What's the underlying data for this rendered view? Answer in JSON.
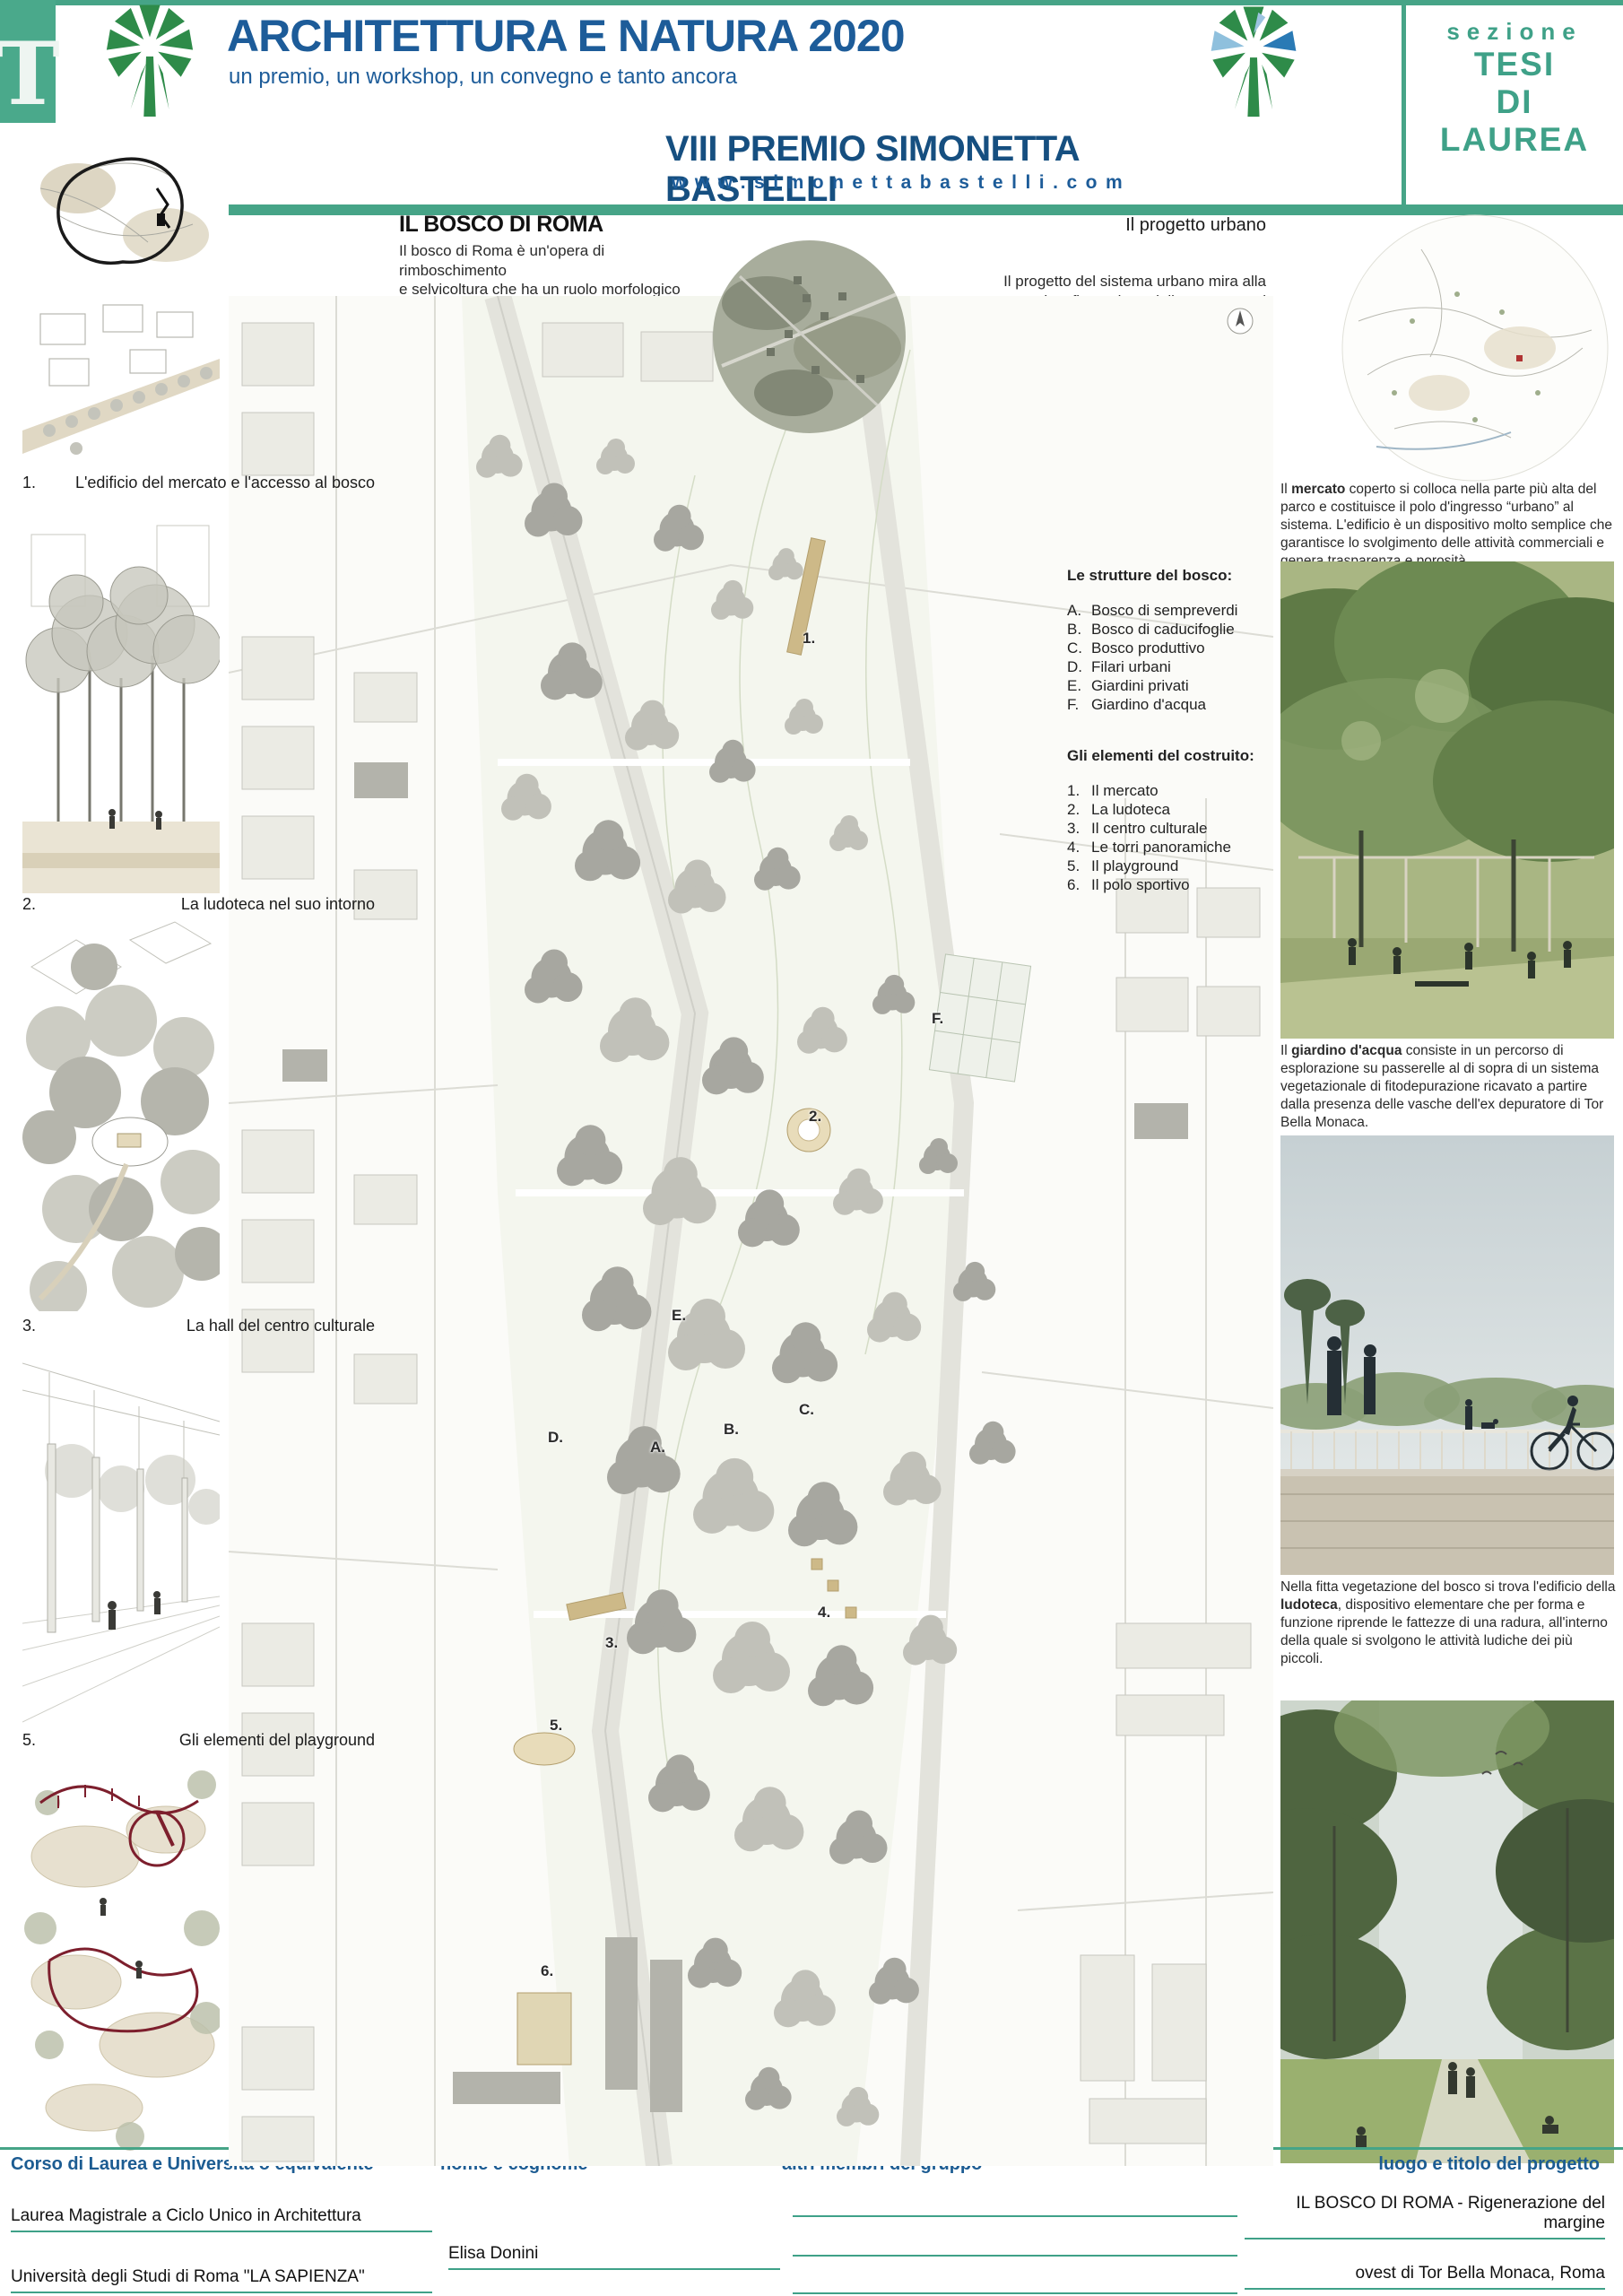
{
  "colors": {
    "accent_green": "#46a487",
    "title_blue": "#1d5c99",
    "logo_green": "#2e8b49",
    "footer_blue": "#1c5c92",
    "playground_red": "#7d1f2d"
  },
  "header": {
    "tab_letter": "T",
    "title": "ARCHITETTURA E NATURA 2020",
    "subtitle": "un premio, un workshop, un convegno e tanto ancora",
    "prize": "VIII PREMIO SIMONETTA BASTELLI",
    "website": "www.simonettabastelli.com",
    "section_label": "sezione",
    "section_lines": [
      "TESI",
      "DI",
      "LAUREA"
    ]
  },
  "intro": {
    "title": "IL BOSCO DI ROMA",
    "body": "Il bosco di Roma è un'opera di rimboschimento\ne selvicoltura che ha un ruolo morfologico\ndi contenimento dello sprawl, definendone\nun margine fisico, e un ruolo ambientale\ndi opposizione all'isolamento di alcuni fragili\nhabitat.\nIl settore di progetto è una fascia di 25 ettari, al\nmargine fra i quartieri di Tor Bella Monaca a est e\nTorre Angela a ovest, nell'ambito della centralità\nlocale n° 3 dell'ex VIII Municipio, oggi VI, di Roma.\nLa centralità ricomprende alcune aree adibite a\nservizi già esistenti (scuole, chiesa, attrezzature\nsportive e ricreative e aree a verde)."
  },
  "urban": {
    "title": "Il progetto urbano",
    "body": "Il progetto del sistema urbano mira alla\nriconfigurazione delle componenti\ninfrastrutturali e storico-ambientali esistenti\nattraverso un ridisegno paesaggistico esteso\nalla scala territoriale.\nLe masse boschive costituiscono la figura\nprincipale del nuovo assetto e vanno a integrarsi\nalla definizione di percorsi pedonali di\ncollegamento fra Tor Bella Monaca\ne Torre Angela e a una pista\nciclabile che prosegue anche verso est."
  },
  "left_panels": [
    {
      "num": "1.",
      "label": "L'edificio del mercato e l'accesso al bosco"
    },
    {
      "num": "2.",
      "label": "La ludoteca nel suo intorno"
    },
    {
      "num": "3.",
      "label": "La hall del centro culturale"
    },
    {
      "num": "5.",
      "label": "Gli elementi del playground"
    }
  ],
  "legend": {
    "bosco_title": "Le strutture del bosco:",
    "bosco": [
      {
        "key": "A.",
        "label": "Bosco di sempreverdi"
      },
      {
        "key": "B.",
        "label": "Bosco di caducifoglie"
      },
      {
        "key": "C.",
        "label": "Bosco produttivo"
      },
      {
        "key": "D.",
        "label": "Filari urbani"
      },
      {
        "key": "E.",
        "label": "Giardini privati"
      },
      {
        "key": "F.",
        "label": "Giardino d'acqua"
      }
    ],
    "costruito_title": "Gli elementi del costruito:",
    "costruito": [
      {
        "key": "1.",
        "label": "Il mercato"
      },
      {
        "key": "2.",
        "label": "La ludoteca"
      },
      {
        "key": "3.",
        "label": "Il centro culturale"
      },
      {
        "key": "4.",
        "label": "Le torri panoramiche"
      },
      {
        "key": "5.",
        "label": "Il playground"
      },
      {
        "key": "6.",
        "label": "Il polo sportivo"
      }
    ]
  },
  "plan": {
    "markers": [
      "1.",
      "2.",
      "3.",
      "4.",
      "5.",
      "6.",
      "A.",
      "B.",
      "C.",
      "D.",
      "E.",
      "F."
    ]
  },
  "captions": [
    {
      "pre": "Il ",
      "bold": "mercato",
      "post": " coperto si colloca nella parte più alta del parco e costituisce il polo d'ingresso “urbano” al sistema. L'edificio è un dispositivo molto semplice che garantisce lo svolgimento delle attività commerciali e genera trasparenza e porosità."
    },
    {
      "pre": "Il ",
      "bold": "giardino d'acqua",
      "post": " consiste in un percorso di esplorazione su passerelle al di sopra di un sistema vegetazionale di fitodepurazione ricavato a partire dalla presenza delle vasche dell'ex depuratore di Tor Bella Monaca."
    },
    {
      "pre": "Nella fitta vegetazione del bosco si trova l'edificio della ",
      "bold": "ludoteca",
      "post": ", dispositivo elementare che per forma e funzione riprende le fattezze di una radura, all'interno della quale si svolgono le attività ludiche dei più piccoli."
    }
  ],
  "footer": {
    "headers": [
      "Corso di Laurea e Università o equivalente",
      "nome e cognome",
      "altri membri del gruppo",
      "luogo e titolo del progetto"
    ],
    "course": "Laurea Magistrale a Ciclo Unico in Architettura",
    "name": "Elisa Donini",
    "university": "Università degli Studi di Roma \"LA SAPIENZA\"",
    "project_line1": "IL BOSCO DI ROMA - Rigenerazione del margine",
    "project_line2": "ovest di Tor Bella Monaca, Roma"
  }
}
